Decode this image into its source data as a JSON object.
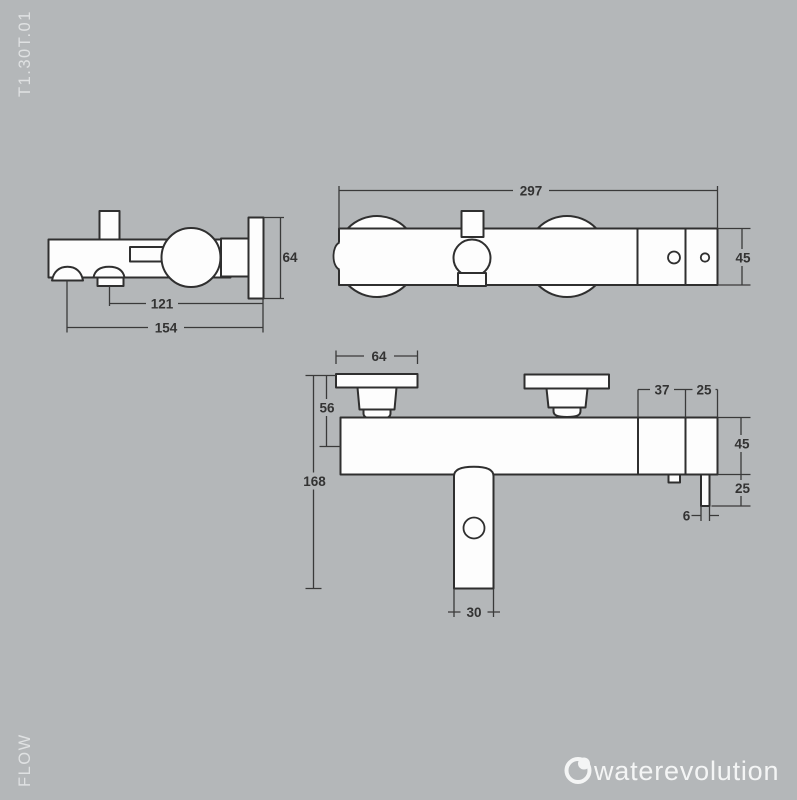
{
  "meta": {
    "product_code": "T1.30T.01",
    "flow_label": "FLOW",
    "brand_name": "waterevolution"
  },
  "colors": {
    "background": "#b4b7b9",
    "drawing_line": "#2f2f2f",
    "drawing_fill": "#fdfdfd",
    "dimension_text": "#333333",
    "margin_text": "#dfe1e2",
    "logo": "#f4f5f5"
  },
  "views": {
    "side_view": {
      "label": "side view",
      "dims": {
        "plate_height": "64",
        "outlet_depth": "121",
        "total_depth": "154"
      }
    },
    "top_view": {
      "label": "top view",
      "dims": {
        "total_width": "297",
        "body_depth": "45"
      }
    },
    "front_view": {
      "label": "front view",
      "dims": {
        "plate_width": "64",
        "plate_drop": "56",
        "total_height": "168",
        "screw_span": "37",
        "screw_edge": "25",
        "body_height": "45",
        "outlet_drop": "25",
        "outlet_width": "6",
        "spout_width": "30"
      }
    }
  }
}
